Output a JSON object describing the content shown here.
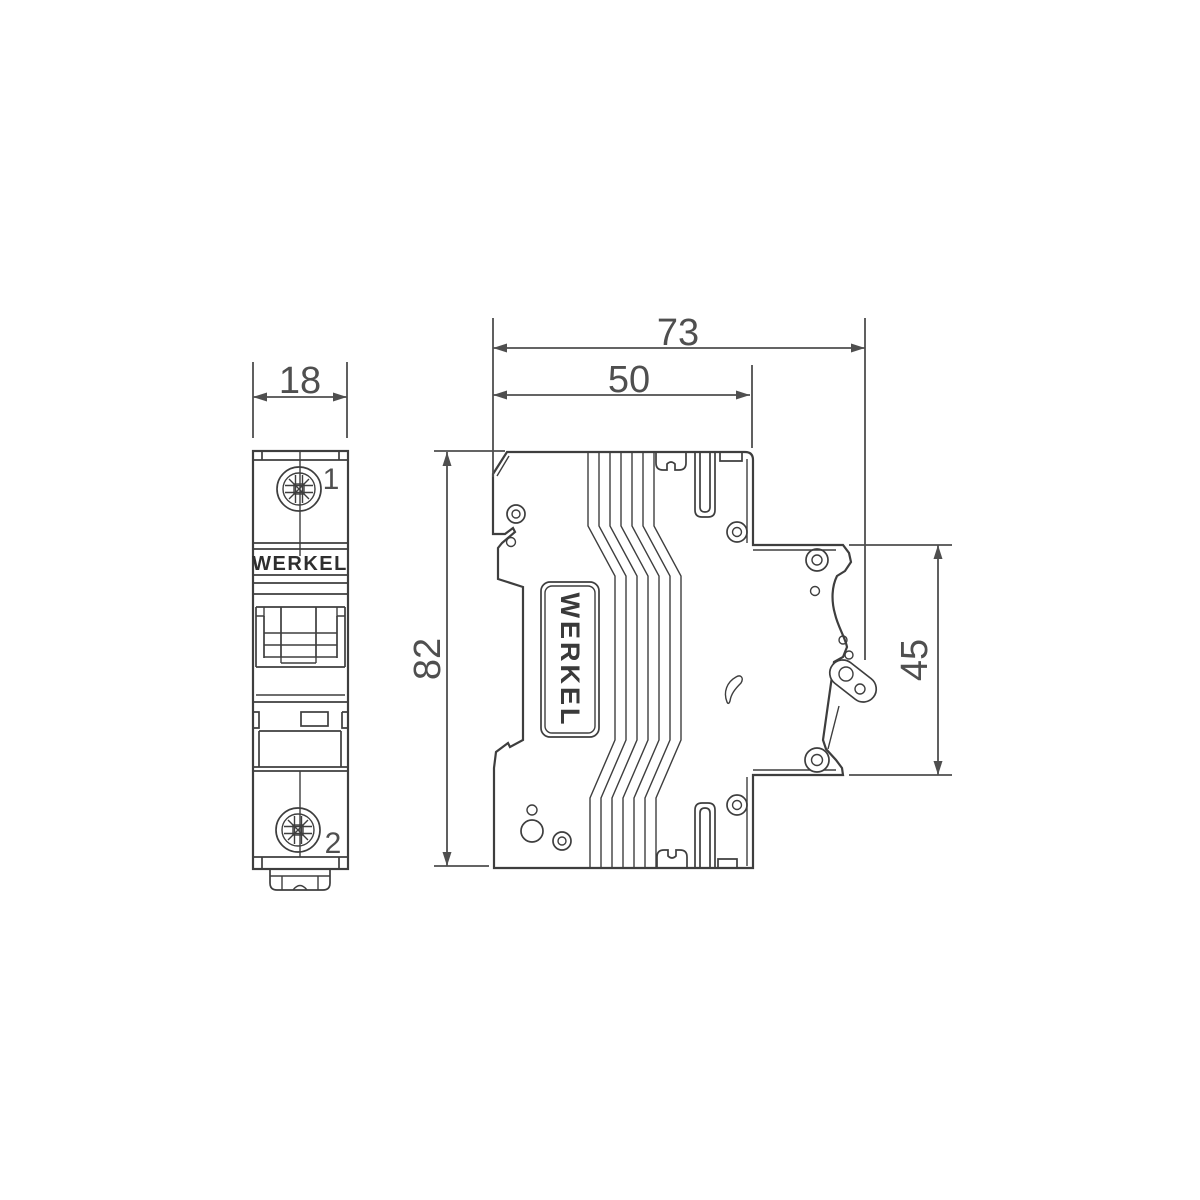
{
  "drawing": {
    "type": "technical drawing, 1-pole circuit breaker, two orthographic views",
    "brand": "WERKEL",
    "colors": {
      "background": "#ffffff",
      "line": "#3e3e3e",
      "dimension": "#4f4f4f"
    },
    "front_view": {
      "name": "front view",
      "brand_label": "WERKEL",
      "terminal_top": "1",
      "terminal_bottom": "2"
    },
    "side_view": {
      "name": "side view",
      "brand_label": "WERKEL"
    },
    "dimensions": {
      "front_width": "18",
      "total_depth": "73",
      "body_depth": "50",
      "height": "82",
      "front_section_height": "45"
    }
  }
}
